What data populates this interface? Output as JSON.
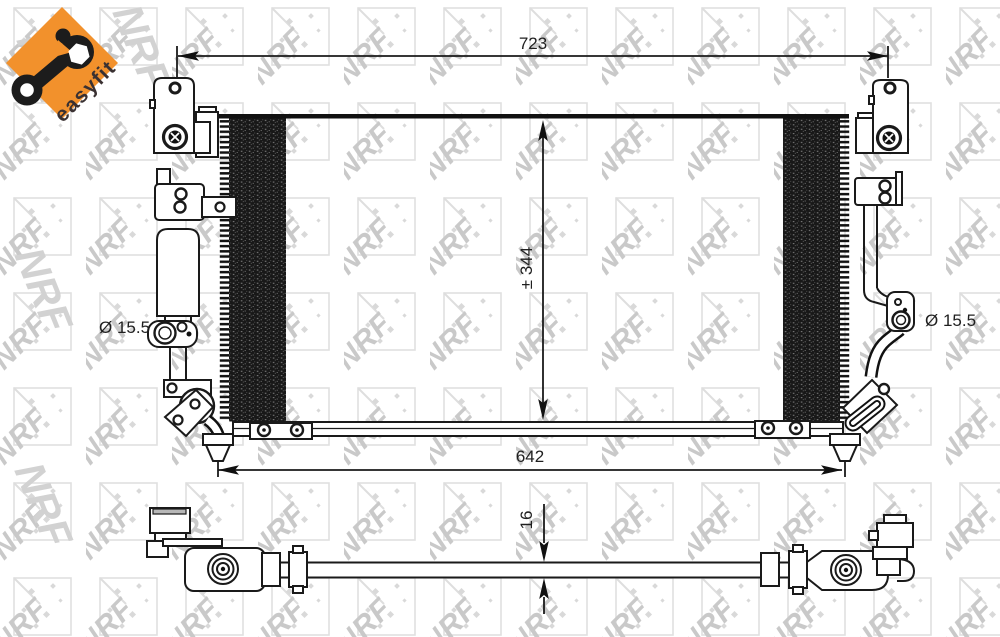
{
  "badge": {
    "label": "easyfit",
    "bg_color": "#f2912c",
    "text_color": "#3a3132",
    "icon": "wrench-icon"
  },
  "watermark": {
    "text": "NRF",
    "tile_color": "#c9c9c9"
  },
  "drawing": {
    "line_color": "#1a1a1a",
    "views": {
      "front": {
        "dimensions": {
          "width_top": "723",
          "core_height": "± 344",
          "width_bottom": "642",
          "port_left_diameter": "Ø 15.5",
          "port_right_diameter": "Ø 15.5"
        }
      },
      "bottom": {
        "dimensions": {
          "depth": "16"
        }
      }
    }
  }
}
